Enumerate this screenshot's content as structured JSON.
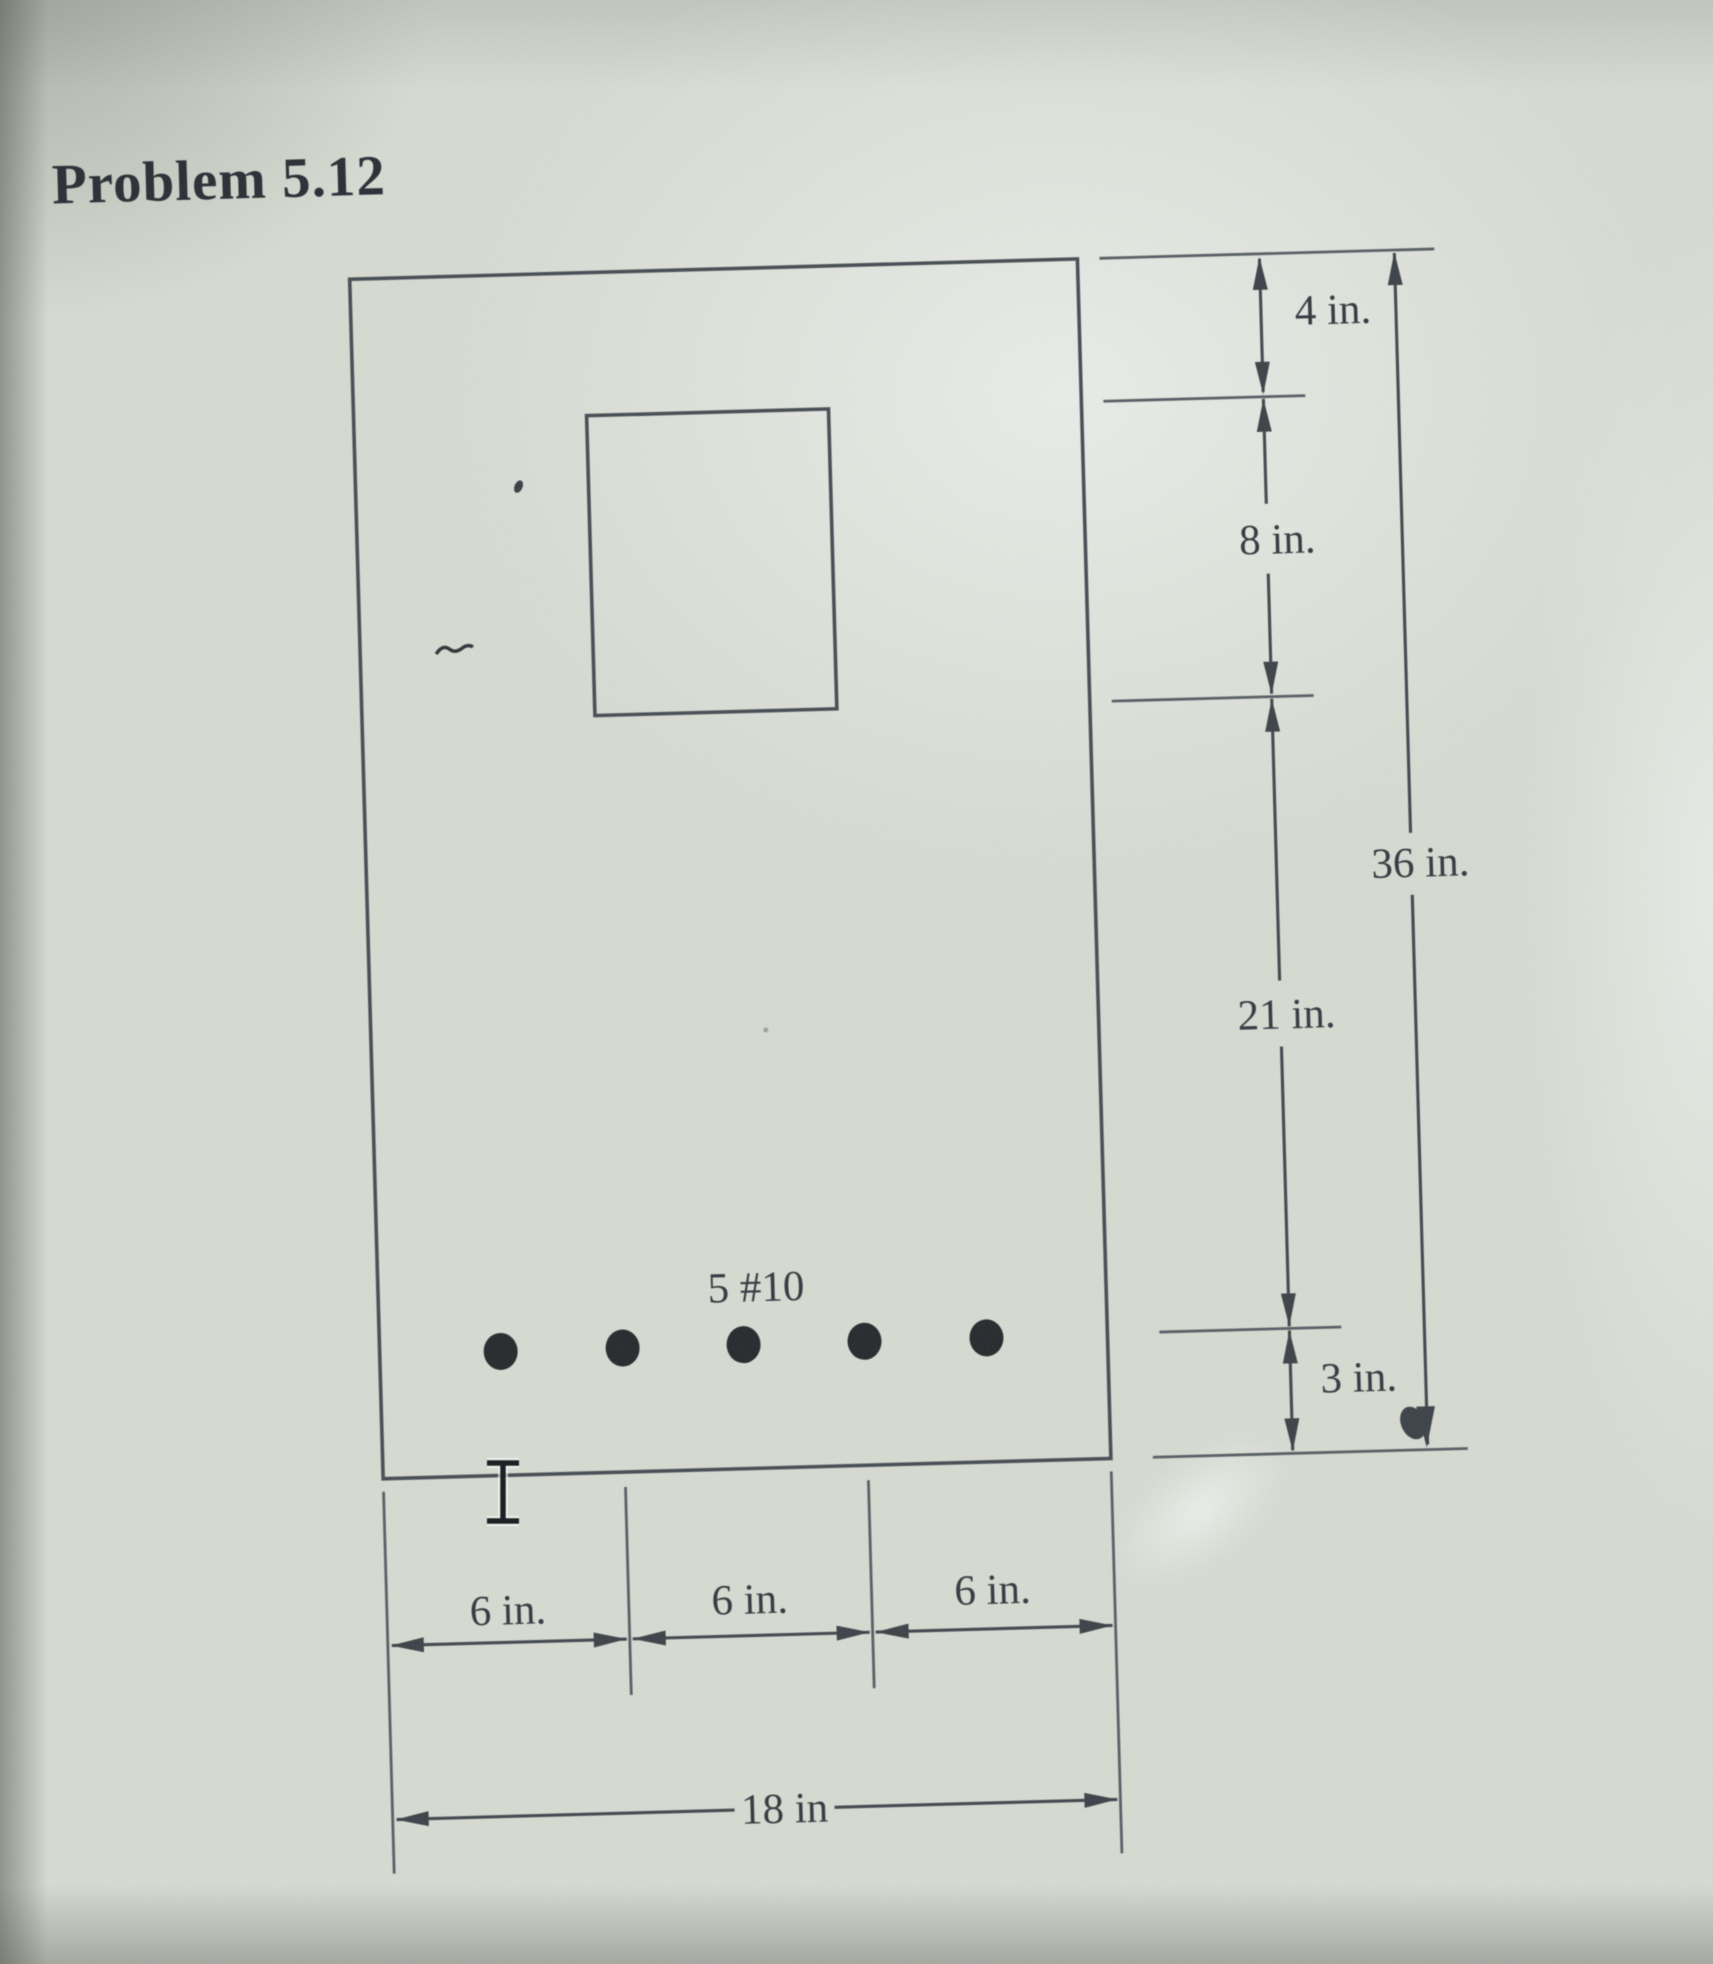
{
  "title": "Problem 5.12",
  "beam_section": {
    "rebar_label": "5 #10",
    "rebar_count": 5,
    "vertical_dimensions": {
      "segment_top": "4 in.",
      "segment_opening": "8 in.",
      "segment_middle": "21 in.",
      "segment_bottom": "3 in.",
      "overall": "36 in."
    },
    "horizontal_dimensions": {
      "segment_1": "6 in.",
      "segment_2": "6 in.",
      "segment_3": "6 in.",
      "overall": "18 in"
    }
  }
}
